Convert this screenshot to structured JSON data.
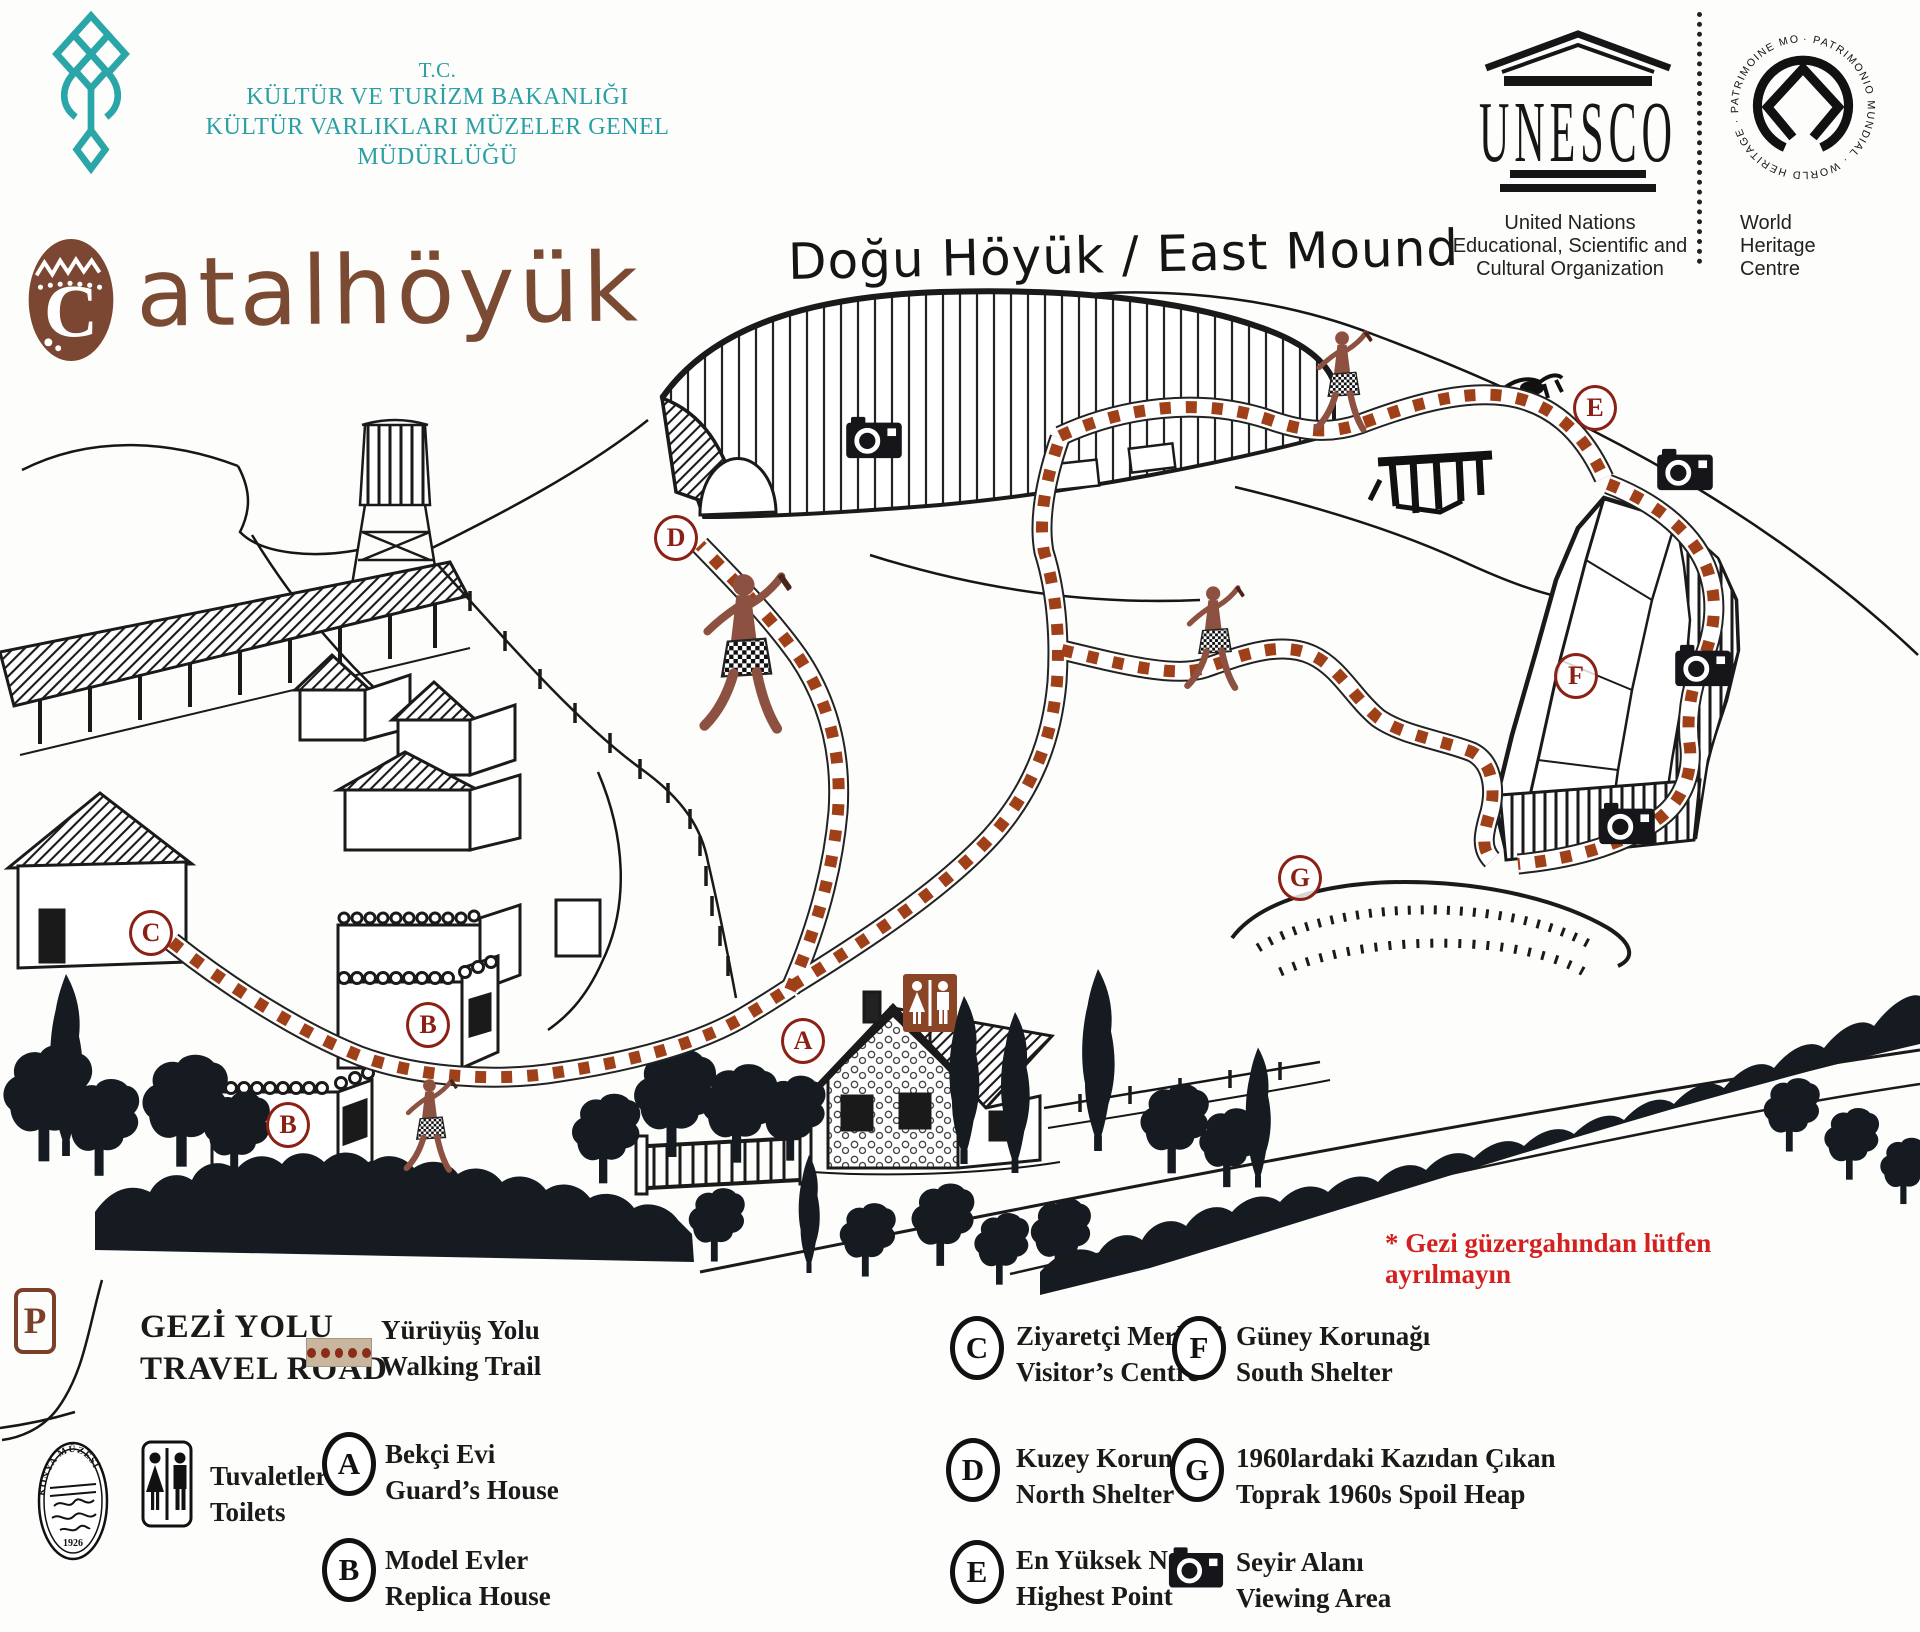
{
  "header": {
    "ministry": {
      "line1": "T.C.",
      "line2": "KÜLTÜR VE TURİZM BAKANLIĞI",
      "line3": "KÜLTÜR VARLIKLARI MÜZELER GENEL MÜDÜRLÜĞÜ"
    },
    "unesco": {
      "logo_text": "UNESCO",
      "caption_line1": "United Nations",
      "caption_line2": "Educational, Scientific and",
      "caption_line3": "Cultural Organization"
    },
    "world_heritage": {
      "ring_text": "· PATRIMONIO MUNDIAL · WORLD HERITAGE · PATRIMOINE MONDIAL ·",
      "caption_line1": "World",
      "caption_line2": "Heritage",
      "caption_line3": "Centre"
    }
  },
  "title": {
    "logo_letter": "C",
    "text": "atalhöyük",
    "subtitle": "Doğu Höyük / East Mound"
  },
  "map": {
    "marker_letters": {
      "a": "A",
      "b": "B",
      "c": "C",
      "d": "D",
      "e": "E",
      "f": "F",
      "g": "G"
    },
    "parking_label": "P",
    "warning": "* Gezi güzergahından lütfen ayrılmayın"
  },
  "legend": {
    "travel_road": {
      "tr": "GEZİ YOLU",
      "en": "TRAVEL ROAD"
    },
    "walking_trail": {
      "tr": "Yürüyüş Yolu",
      "en": "Walking Trail"
    },
    "toilets": {
      "tr": "Tuvaletler",
      "en": "Toilets"
    },
    "items": {
      "a": {
        "letter": "A",
        "tr": "Bekçi Evi",
        "en": "Guard’s House"
      },
      "b": {
        "letter": "B",
        "tr": "Model Evler",
        "en": "Replica House"
      },
      "c": {
        "letter": "C",
        "tr": "Ziyaretçi Merkezi",
        "en": "Visitor’s Centre"
      },
      "d": {
        "letter": "D",
        "tr": "Kuzey Korunağı",
        "en": "North Shelter"
      },
      "e": {
        "letter": "E",
        "tr": "En Yüksek Nokta",
        "en": "Highest Point"
      },
      "f": {
        "letter": "F",
        "tr": "Güney Korunağı",
        "en": "South Shelter"
      },
      "g": {
        "letter": "G",
        "tr": "1960lardaki Kazıdan Çıkan",
        "en": "Toprak  1960s Spoil Heap"
      },
      "camera": {
        "tr": "Seyir Alanı",
        "en": "Viewing Area"
      }
    }
  },
  "seal": {
    "top": "KONYA MÜZESİ",
    "year": "1926"
  },
  "colors": {
    "brand_teal": "#2aa5a8",
    "title_brown": "#7a4a33",
    "trail_rust": "#a04019",
    "marker_red": "#8b2015",
    "warning_red": "#d32020",
    "sign_brown": "#8a4526",
    "ink": "#1a1a1a",
    "tree_dark": "#161b22"
  }
}
